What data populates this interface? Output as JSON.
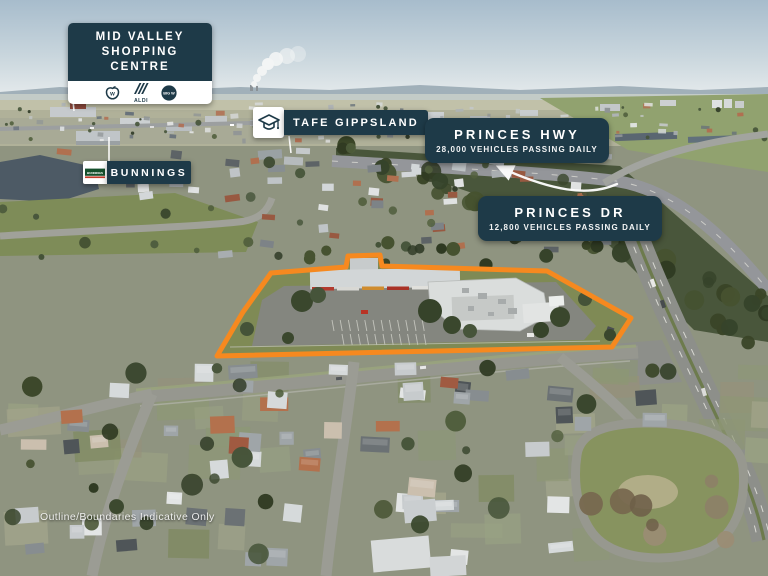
{
  "colors": {
    "label_navy": "#1e3a48",
    "outline_orange": "#f6891f",
    "pointer_white": "#ffffff"
  },
  "labels": {
    "mid_valley": {
      "line1": "MID VALLEY",
      "line2": "SHOPPING CENTRE",
      "logos": {
        "woolworths": "w",
        "aldi": "ALDI",
        "bigw": "BIG W"
      }
    },
    "bunnings": {
      "text": "BUNNINGS",
      "logo_text": "BUNNINGS"
    },
    "tafe": {
      "text": "TAFE GIPPSLAND"
    },
    "princes_hwy": {
      "title": "PRINCES HWY",
      "subtitle": "28,000 VEHICLES PASSING DAILY"
    },
    "princes_dr": {
      "title": "PRINCES DR",
      "subtitle": "12,800 VEHICLES PASSING DAILY"
    }
  },
  "disclaimer": "Outline/Boundaries Indicative Only",
  "scene": {
    "type": "oblique aerial photograph of a suburban town",
    "highlight": "commercial shopping-centre site outlined in orange"
  }
}
